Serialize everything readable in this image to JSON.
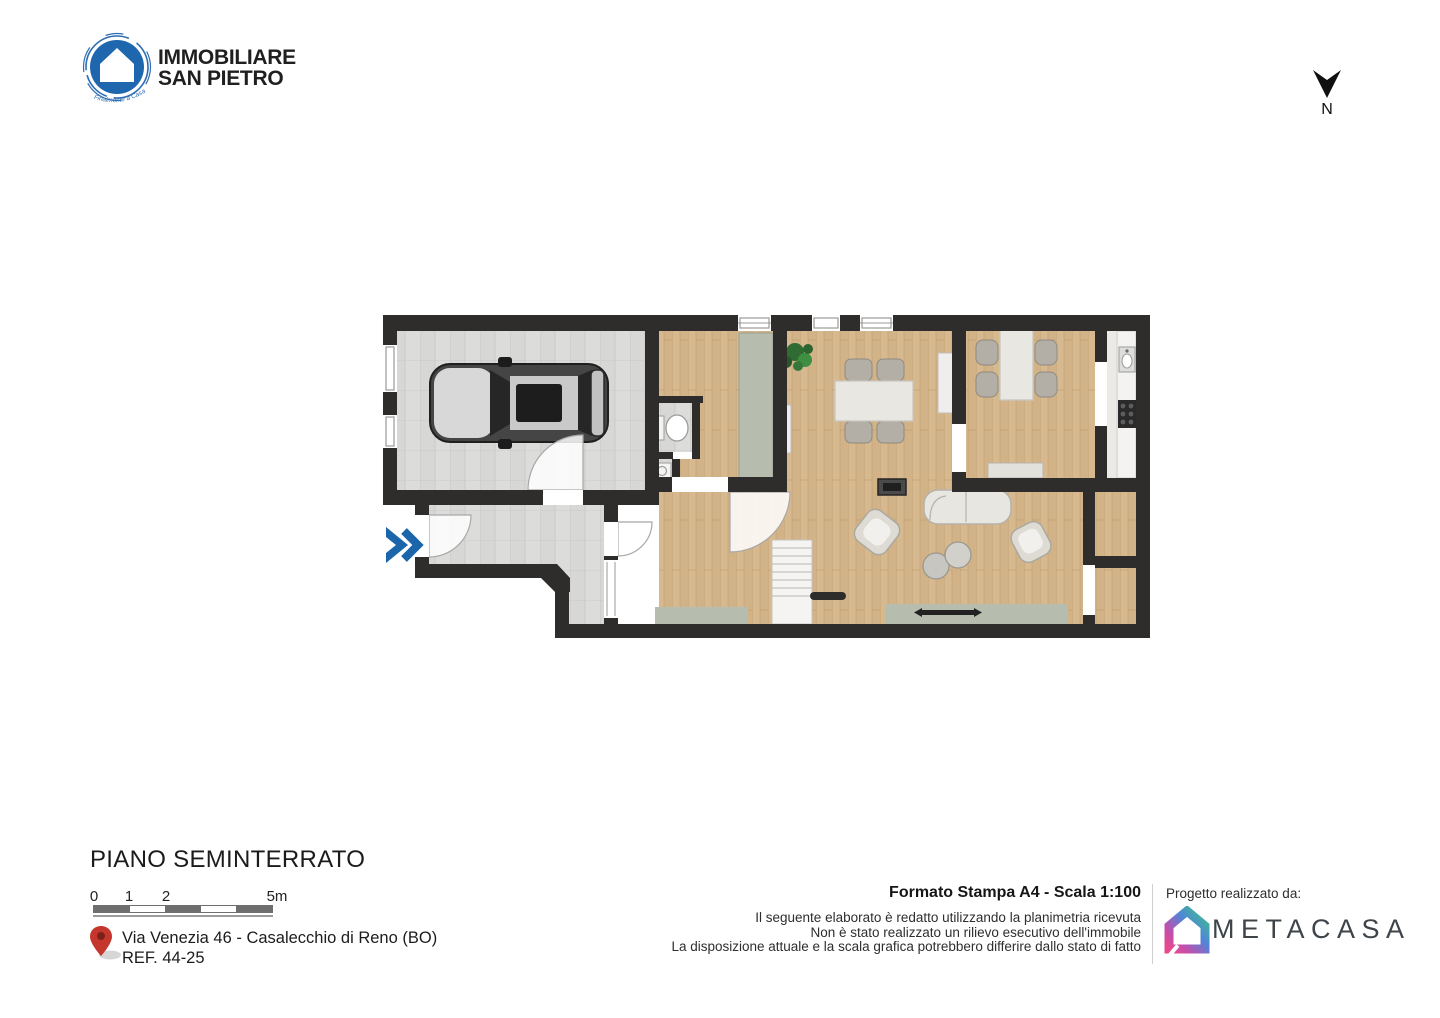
{
  "branding": {
    "logo_line1": "IMMOBILIARE",
    "logo_line2": "SAN PIETRO",
    "logo_tagline": "Finalmente a Casa"
  },
  "compass": {
    "north_label": "N"
  },
  "plan": {
    "title": "PIANO SEMINTERRATO"
  },
  "scale_bar": {
    "labels": [
      "0",
      "1",
      "2",
      "5m"
    ]
  },
  "address": {
    "line1": "Via Venezia 46 - Casalecchio di Reno (BO)",
    "line2": "REF. 44-25"
  },
  "print_info": {
    "title": "Formato Stampa A4 - Scala 1:100",
    "disclaimer1": "Il seguente elaborato è redatto utilizzando la planimetria ricevuta",
    "disclaimer2": "Non è stato realizzato un rilievo esecutivo dell'immobile",
    "disclaimer3": "La disposizione attuale e la scala grafica potrebbero differire dallo stato di fatto"
  },
  "credits": {
    "label": "Progetto realizzato da:",
    "brand": "METACASA"
  },
  "colors": {
    "brand_blue": "#1e67ae",
    "wall_dark": "#2e2d2b",
    "wood_floor": "#d7b98f",
    "tile_gray": "#dcdcda",
    "sage_green": "#b7bdae",
    "pin_red": "#c5372c",
    "entrance_arrow_blue": "#1b66aa",
    "metacasa_text": "#3f444a",
    "metacasa_gradient": [
      "#3fbf8a",
      "#4f86d8",
      "#c04fae",
      "#e8498c"
    ]
  }
}
